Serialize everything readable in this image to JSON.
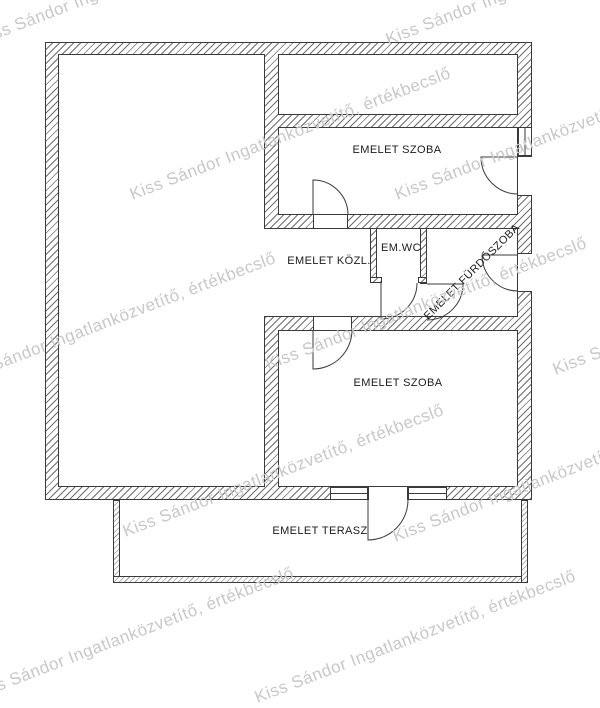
{
  "plan": {
    "labels": {
      "upper_room": "EMELET SZOBA",
      "hallway": "EMELET KÖZL.",
      "wc": "EM.WC",
      "bathroom": "EMELET FÜRDŐSZOBA",
      "lower_room": "EMELET SZOBA",
      "terrace": "EMELET TERASZ"
    },
    "colors": {
      "wall_outline": "#3a3a3a",
      "hatch_line": "#6e6e6e",
      "label_text": "#1b1b1b",
      "watermark": "#c8c8c8",
      "background": "#ffffff"
    }
  },
  "watermark": {
    "text": "Kiss Sándor Ingatlanközvetítő, értékbecslő",
    "angle_deg": -21,
    "font_size_px": 17,
    "instances": [
      {
        "x": -25,
        "y": 31
      },
      {
        "x": 383,
        "y": 31
      },
      {
        "x": 127,
        "y": 186
      },
      {
        "x": 392,
        "y": 186
      },
      {
        "x": -48,
        "y": 371
      },
      {
        "x": 263,
        "y": 356
      },
      {
        "x": 550,
        "y": 361
      },
      {
        "x": 120,
        "y": 523
      },
      {
        "x": 390,
        "y": 528
      },
      {
        "x": -30,
        "y": 686
      },
      {
        "x": 252,
        "y": 689
      }
    ]
  }
}
